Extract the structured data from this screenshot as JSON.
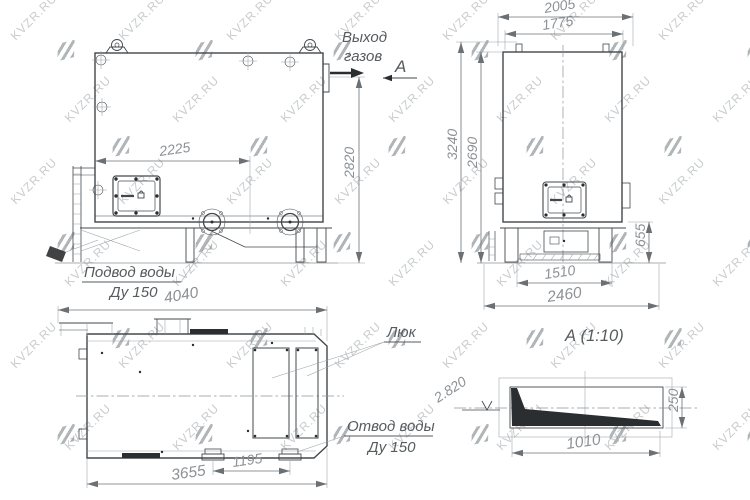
{
  "watermark": {
    "text": "KVZR.RU"
  },
  "views": {
    "front": {
      "gas_outlet_label_line1": "Выход",
      "gas_outlet_label_line2": "газов",
      "section_label": "А",
      "water_supply_label_line1": "Подвод воды",
      "water_supply_label_line2": "Ду 150",
      "dims": {
        "nozzle_offset": "2225",
        "height": "2820"
      }
    },
    "side": {
      "dims": {
        "overall_width": "2005",
        "body_width": "1775",
        "overall_height": "3240",
        "body_height": "2690",
        "support_height": "655",
        "leg_span": "1510",
        "base_width": "2460"
      }
    },
    "top": {
      "hatch_label": "Люк",
      "water_outlet_label_line1": "Отвод воды",
      "water_outlet_label_line2": "Ду 150",
      "dims": {
        "overall_length": "4040",
        "body_length": "3655",
        "nozzle_span": "1195"
      }
    },
    "detail_a": {
      "title": "А  (1:10)",
      "elevation_mark": "2.820",
      "dims": {
        "length": "1010",
        "height": "250"
      }
    }
  }
}
